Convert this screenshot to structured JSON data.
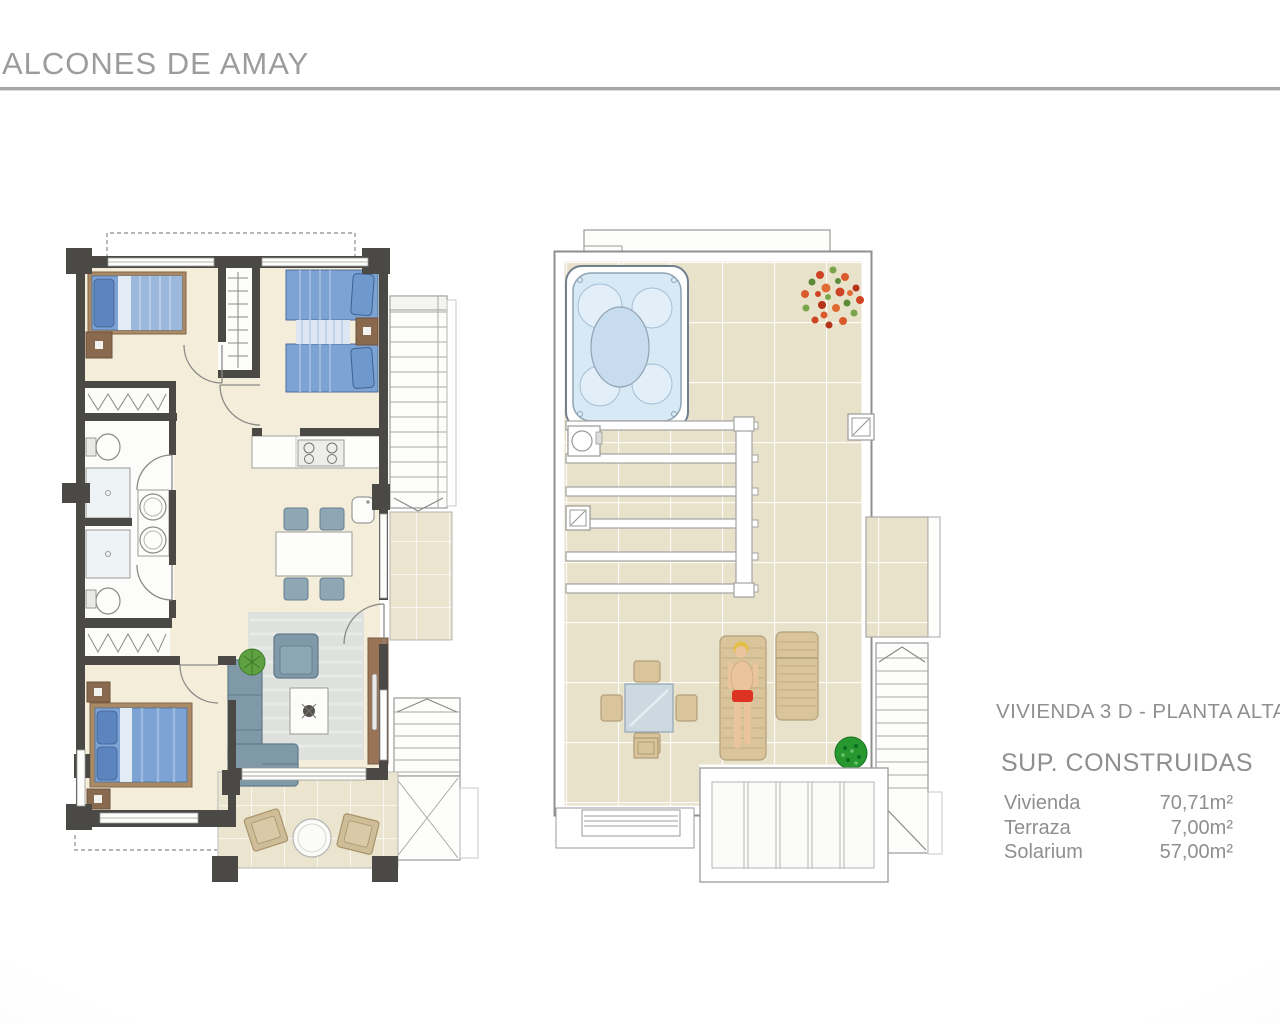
{
  "page": {
    "title": "ALCONES DE AMAY"
  },
  "info": {
    "plan_title": "VIVIENDA 3 D - PLANTA ALTA",
    "surfaces_title": "SUP. CONSTRUIDAS",
    "surfaces": {
      "rows": [
        {
          "label": "Vivienda",
          "value": "70,71m²"
        },
        {
          "label": "Terraza",
          "value": "7,00m²"
        },
        {
          "label": "Solarium",
          "value": "57,00m²"
        }
      ]
    }
  },
  "plans": {
    "upper_floor": {
      "label": "Vivienda planta alta",
      "rooms": [
        "bedroom-1",
        "bedroom-2",
        "bathroom-1",
        "bathroom-2",
        "master-bedroom",
        "hall",
        "kitchen",
        "living-dining-room",
        "terrace",
        "exterior-stairs"
      ]
    },
    "solarium": {
      "label": "Solarium",
      "features": [
        "jacuzzi",
        "pergola-beams",
        "flower-plant",
        "outdoor-dining-set",
        "sun-lounger",
        "sunbather",
        "bush",
        "roof-vents",
        "chimney-vent",
        "louver-structure",
        "stairs"
      ]
    }
  },
  "colors": {
    "wall": "#4b4946",
    "floor_cream": "#f4edda",
    "tile_beige": "#e9e2cb",
    "bed_blue": "#7da3d4",
    "sofa_gray": "#8099a8",
    "wood_tan": "#d9c49c",
    "water_blue": "#d7e9f5",
    "text_gray": "#8f8f8f",
    "title_gray": "#9c9c9a"
  }
}
